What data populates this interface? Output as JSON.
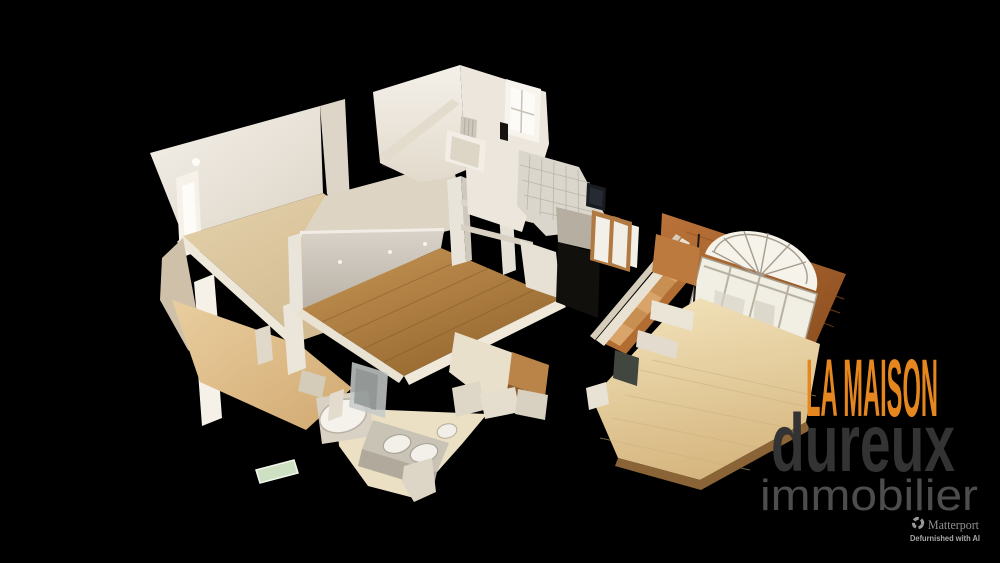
{
  "viewer": {
    "scene_description": "3D dollhouse cutaway view of a two-story house interior"
  },
  "branding": {
    "title": "LA MAISON",
    "name": "dureux",
    "subtitle": "immobilier"
  },
  "attribution": {
    "provider": "Matterport",
    "note": "Defurnished with AI"
  },
  "colors": {
    "background": "#000000",
    "accent_orange": "#e5861f",
    "brand_dark_gray": "#333333",
    "brand_mid_gray": "#4d4d4d",
    "attribution_gray": "#919191",
    "attribution_note_gray": "#a8a8a8"
  }
}
